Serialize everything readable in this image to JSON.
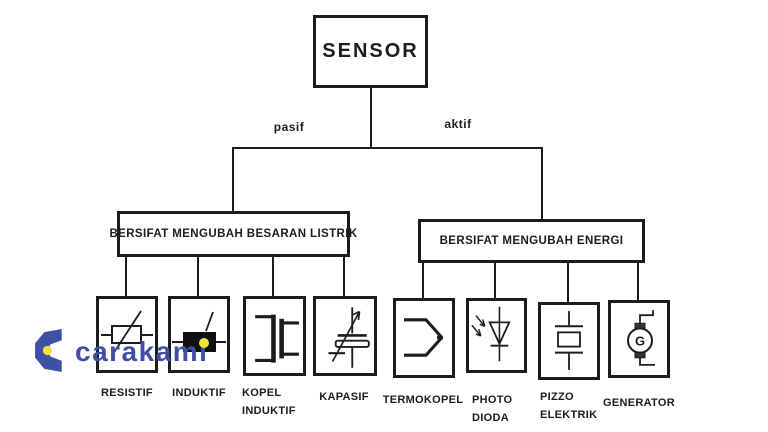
{
  "root_label": "SENSOR",
  "branches": [
    {
      "edge_label": "pasif",
      "category_label": "BERSIFAT MENGUBAH BESARAN LISTRIK",
      "children": [
        {
          "icon": "resistor-icon",
          "label1": "RESISTIF",
          "label2": ""
        },
        {
          "icon": "inductor-icon",
          "label1": "INDUKTIF",
          "label2": ""
        },
        {
          "icon": "coupled-inductor-icon",
          "label1": "KOPEL",
          "label2": "INDUKTIF"
        },
        {
          "icon": "variable-capacitor-icon",
          "label1": "KAPASIF",
          "label2": ""
        }
      ]
    },
    {
      "edge_label": "aktif",
      "category_label": "BERSIFAT MENGUBAH ENERGI",
      "children": [
        {
          "icon": "thermocouple-icon",
          "label1": "TERMOKOPEL",
          "label2": ""
        },
        {
          "icon": "photodiode-icon",
          "label1": "PHOTO",
          "label2": "DIODA"
        },
        {
          "icon": "piezoelectric-icon",
          "label1": "PIZZO",
          "label2": "ELEKTRIK"
        },
        {
          "icon": "generator-icon",
          "label1": "GENERATOR",
          "label2": "",
          "symbol_text": "G"
        }
      ]
    }
  ],
  "watermark": {
    "text": "carakami"
  },
  "colors": {
    "line": "#1c1c1c",
    "background": "#ffffff",
    "watermark_blue": "#3f4fa3",
    "watermark_yellow": "#f0e23c"
  }
}
